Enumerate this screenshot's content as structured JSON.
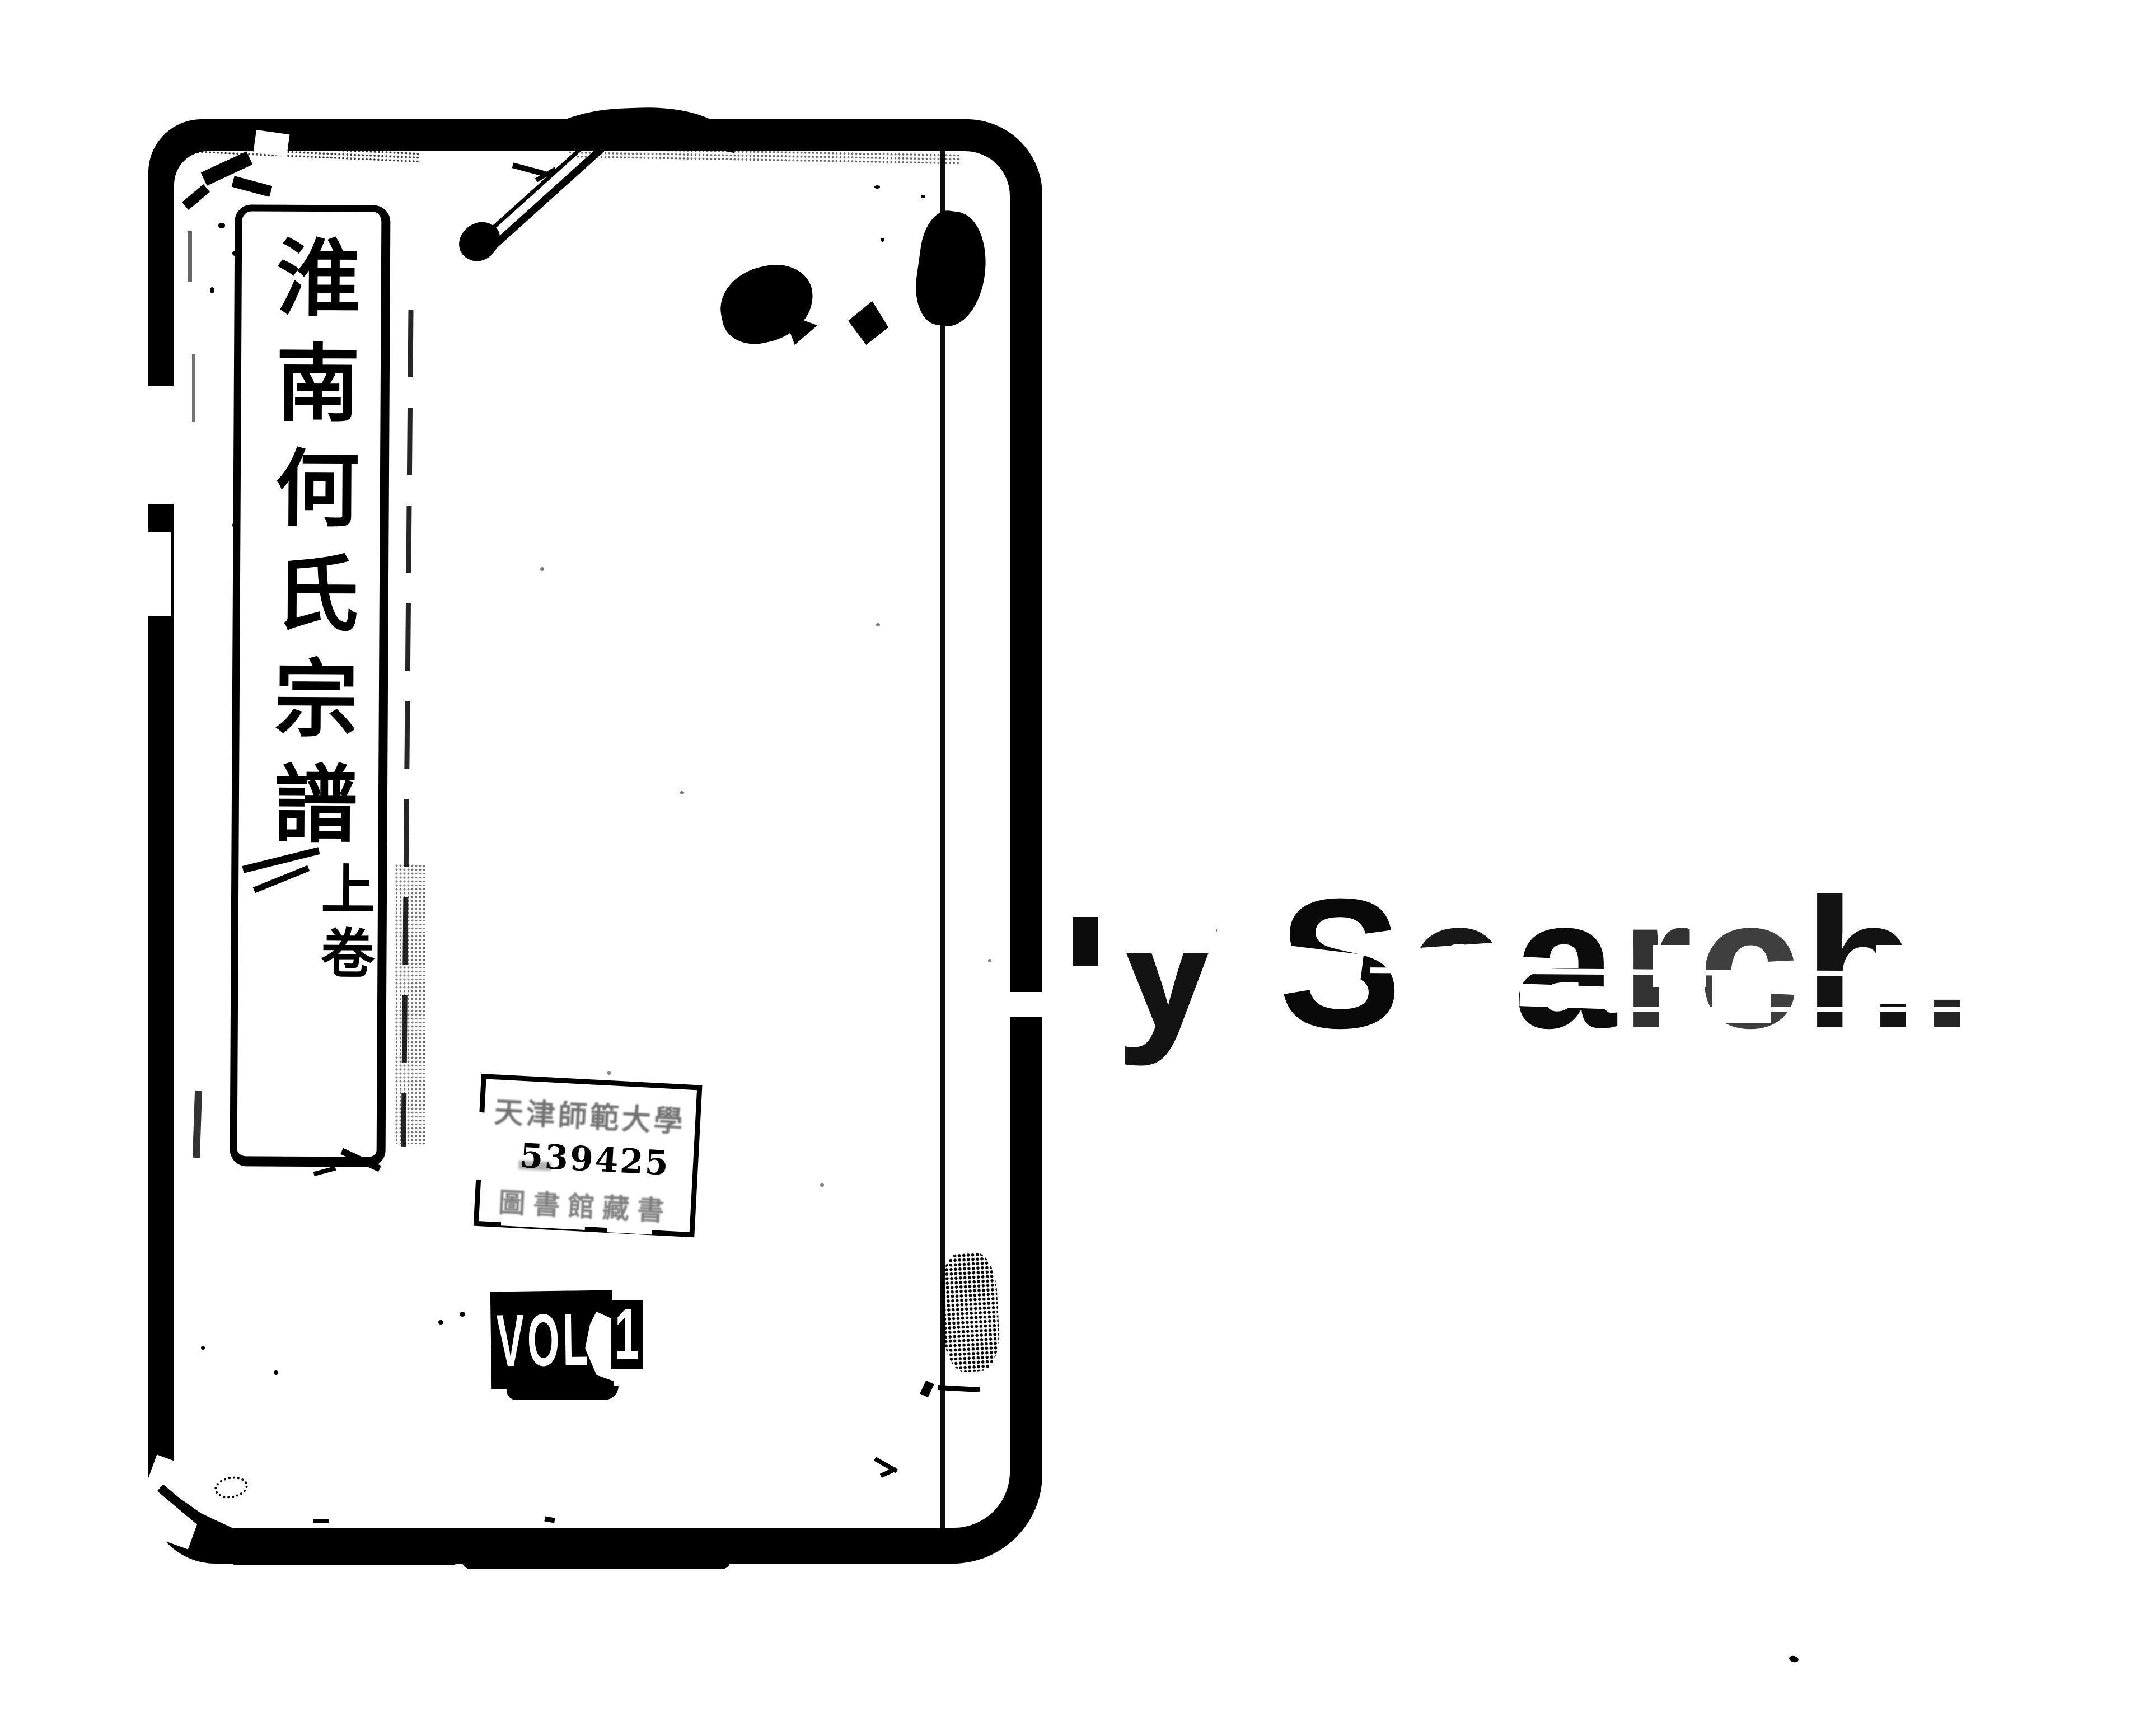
{
  "book_cover": {
    "title_label": {
      "title": "淮南何氏宗譜",
      "volume": "上卷"
    },
    "library_stamp": {
      "line1": "天津師範大學",
      "accession_number": "539425",
      "line3": "圖書館藏書"
    },
    "volume_sticker": {
      "vol": "VOL",
      "number": "1"
    }
  },
  "watermark": {
    "text": "ly Search.",
    "letters": [
      "l",
      "y",
      " ",
      "S",
      "e",
      "a",
      "r",
      "c",
      "h",
      "."
    ]
  },
  "colors": {
    "ink": "#000000",
    "paper": "#ffffff"
  }
}
